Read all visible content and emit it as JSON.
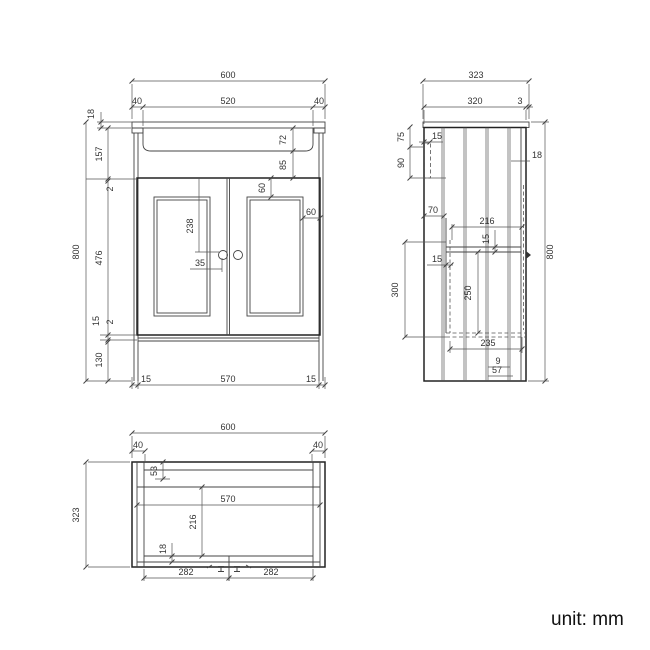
{
  "front": {
    "width": "600",
    "basin_width": "520",
    "overhang_l": "40",
    "overhang_r": "40",
    "top_thk": "18",
    "apron": "157",
    "gap_top": "2",
    "door_h": "476",
    "rail": "15",
    "gap_bot": "2",
    "plinth": "130",
    "height": "800",
    "basin_depth": "72",
    "basin_gap": "85",
    "panel_top": "60",
    "panel_side": "60",
    "knob_drop": "238",
    "knob_off": "35",
    "foot_l": "15",
    "span": "570",
    "foot_r": "15"
  },
  "side": {
    "depth": "323",
    "body": "320",
    "lip": "3",
    "bracket_top": "75",
    "bracket_h": "90",
    "bracket_d": "15",
    "front_thk": "18",
    "plank": "70",
    "shelf_d": "216",
    "shelf_t": "15",
    "side_in": "15",
    "drop": "300",
    "below": "250",
    "bottom_d": "235",
    "foot_a": "9",
    "foot_b": "57",
    "height": "800"
  },
  "plan": {
    "width": "600",
    "side_l": "40",
    "side_r": "40",
    "depth": "323",
    "back_rail": "53",
    "span": "570",
    "door_d": "216",
    "front_rail": "18",
    "door_l": "282",
    "door_r": "282"
  },
  "footer": {
    "unit": "unit: mm"
  }
}
